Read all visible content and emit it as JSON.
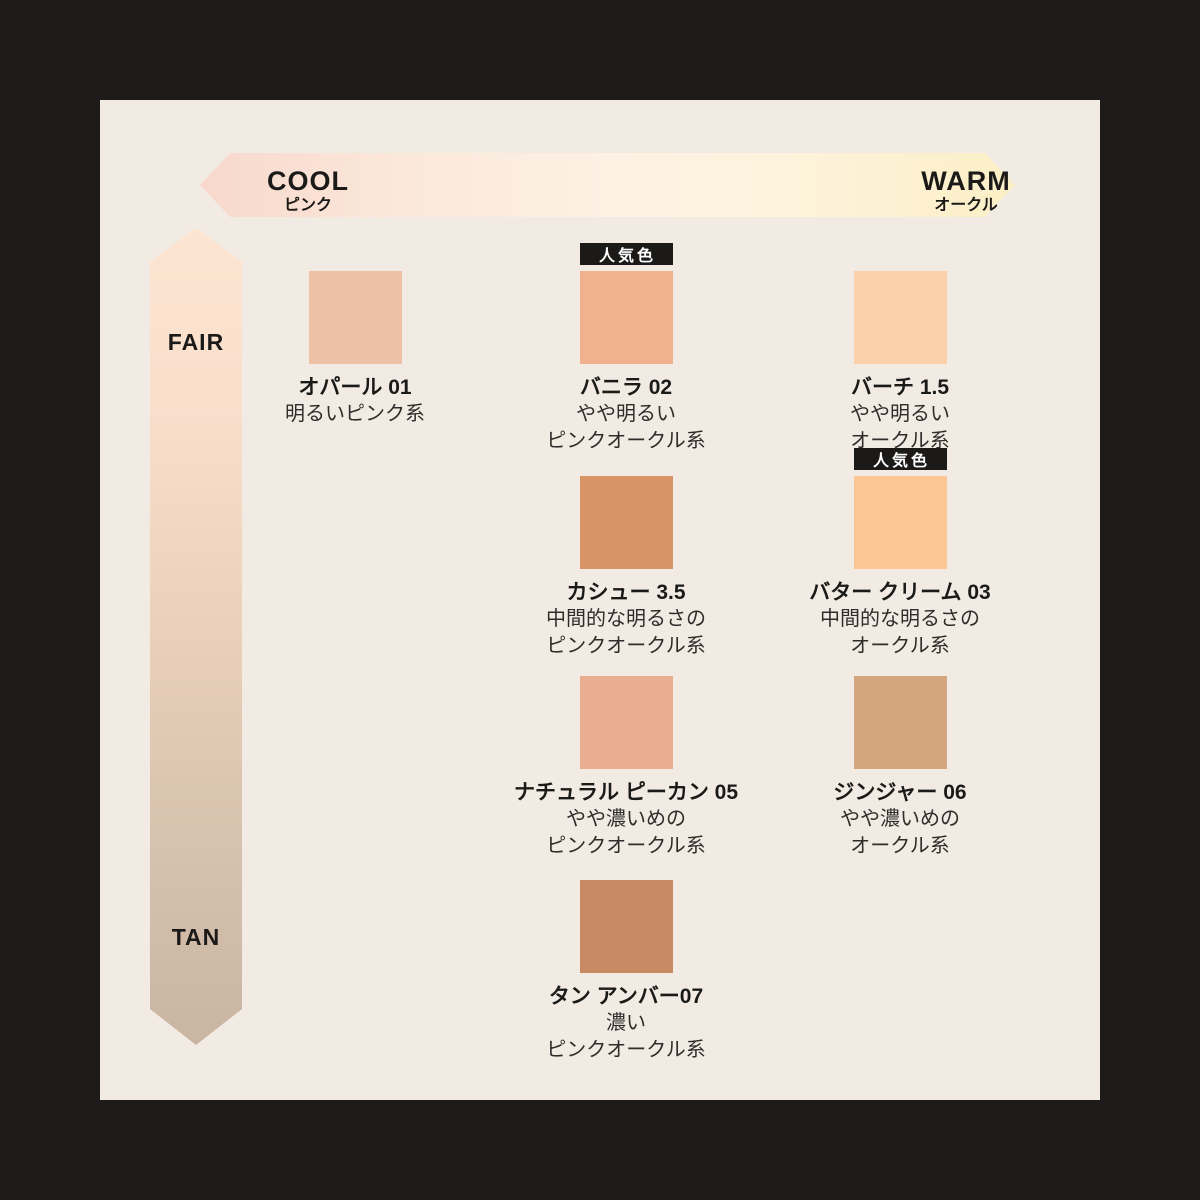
{
  "frame": {
    "bg": "#1c1b19",
    "panel_bg": "#f2ebe3"
  },
  "badge_label": "人気色",
  "axes": {
    "horizontal": {
      "left_label": "COOL",
      "left_sublabel": "ピンク",
      "right_label": "WARM",
      "right_sublabel": "オークル",
      "gradient": [
        "#f8d8cd",
        "#fbe8da",
        "#fdf1e4",
        "#fdf2da",
        "#fbefc6"
      ]
    },
    "vertical": {
      "top_label": "FAIR",
      "bottom_label": "TAN",
      "gradient": [
        "#fce5d2",
        "#f7decb",
        "#e9d0ba",
        "#d6c2ae",
        "#c9b5a2"
      ]
    }
  },
  "shades": [
    {
      "name": "オパール 01",
      "desc": [
        "明るいピンク系"
      ],
      "color": "#eec1a6",
      "popular": false
    },
    {
      "name": "バニラ 02",
      "desc": [
        "やや明るい",
        "ピンクオークル系"
      ],
      "color": "#f0b28d",
      "popular": true
    },
    {
      "name": "バーチ 1.5",
      "desc": [
        "やや明るい",
        "オークル系"
      ],
      "color": "#fbd0ab",
      "popular": false
    },
    {
      "name": "カシュー 3.5",
      "desc": [
        "中間的な明るさの",
        "ピンクオークル系"
      ],
      "color": "#d79467",
      "popular": false
    },
    {
      "name": "バター クリーム 03",
      "desc": [
        "中間的な明るさの",
        "オークル系"
      ],
      "color": "#fcc794",
      "popular": true
    },
    {
      "name": "ナチュラル ピーカン 05",
      "desc": [
        "やや濃いめの",
        "ピンクオークル系"
      ],
      "color": "#e9ae8f",
      "popular": false
    },
    {
      "name": "ジンジャー 06",
      "desc": [
        "やや濃いめの",
        "オークル系"
      ],
      "color": "#d3a67f",
      "popular": false
    },
    {
      "name": "タン アンバー07",
      "desc": [
        "濃い",
        "ピンクオークル系"
      ],
      "color": "#c88a63",
      "popular": false
    }
  ]
}
